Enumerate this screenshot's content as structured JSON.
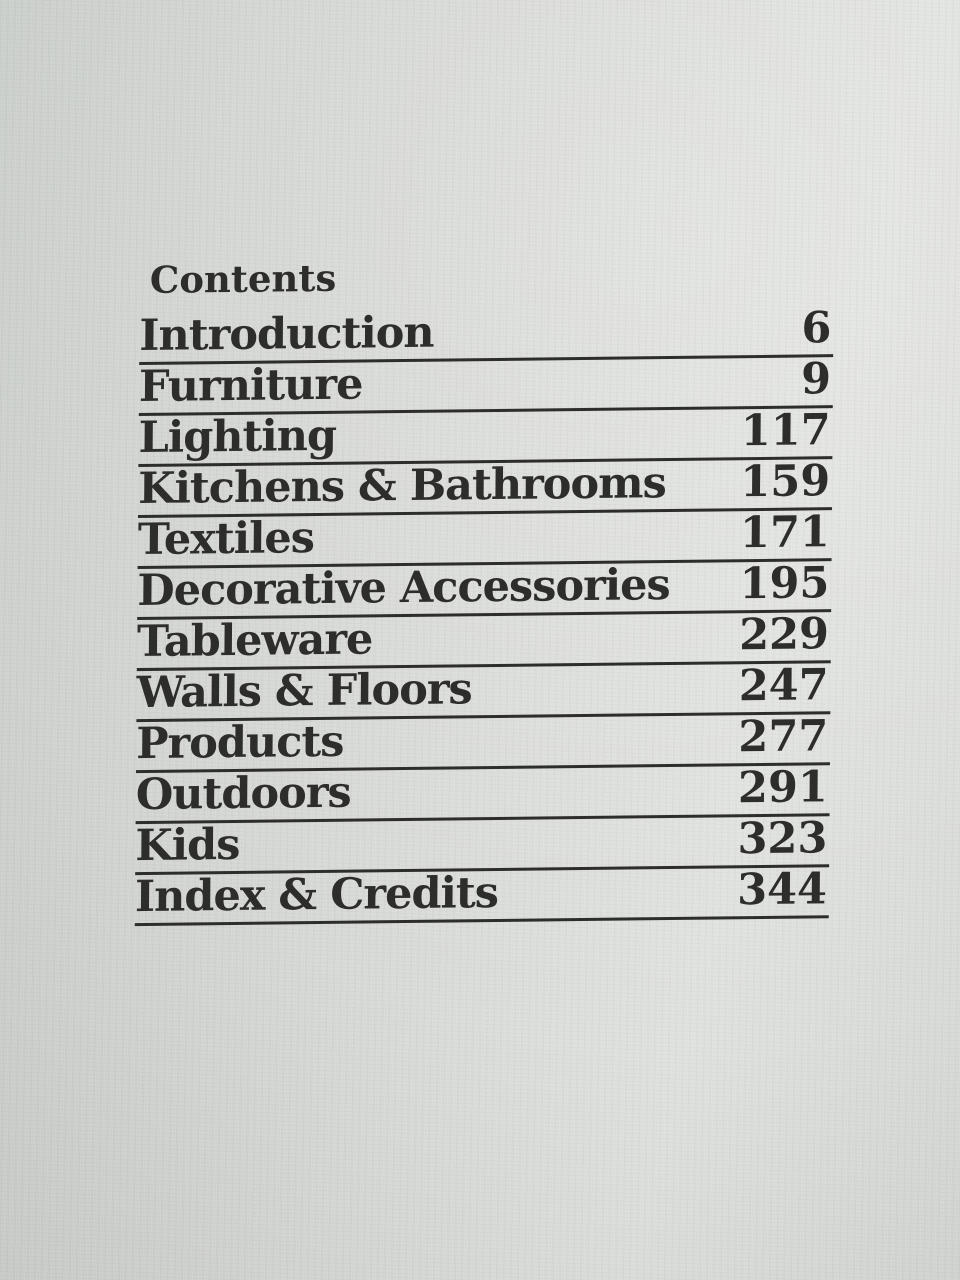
{
  "page": {
    "title": "Contents",
    "items": [
      {
        "label": "Introduction",
        "page": "6"
      },
      {
        "label": "Furniture",
        "page": "9"
      },
      {
        "label": "Lighting",
        "page": "117"
      },
      {
        "label": "Kitchens & Bathrooms",
        "page": "159"
      },
      {
        "label": "Textiles",
        "page": "171"
      },
      {
        "label": "Decorative Accessories",
        "page": "195"
      },
      {
        "label": "Tableware",
        "page": "229"
      },
      {
        "label": "Walls & Floors",
        "page": "247"
      },
      {
        "label": "Products",
        "page": "277"
      },
      {
        "label": "Outdoors",
        "page": "291"
      },
      {
        "label": "Kids",
        "page": "323"
      },
      {
        "label": "Index & Credits",
        "page": "344"
      }
    ],
    "colors": {
      "paper": "#d8dad7",
      "ink": "#2d2d2b"
    }
  }
}
